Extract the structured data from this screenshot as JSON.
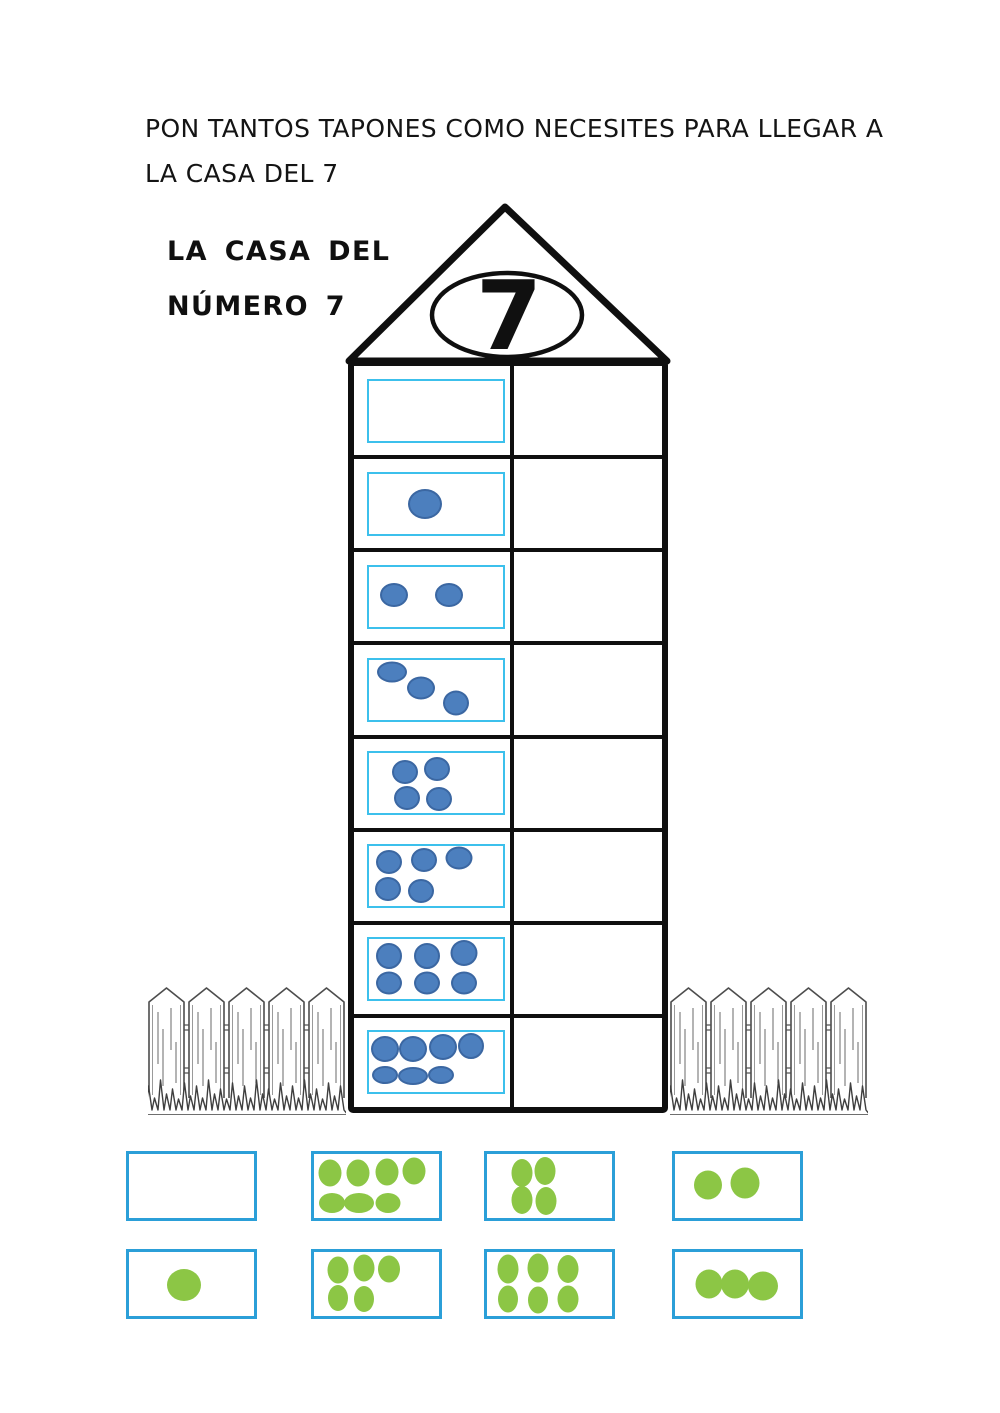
{
  "instruction": {
    "line1": "PON TANTOS TAPONES COMO NECESITES PARA LLEGAR A",
    "line2": "LA CASA DEL 7"
  },
  "house": {
    "label_line1": "LA CASA DEL",
    "label_line2": "NÚMERO 7",
    "roof_number": "7",
    "dot_fill": "#4c7fbe",
    "dot_stroke": "#3b67a2",
    "box_border": "#3cc0ec",
    "rows": [
      {
        "count": 0,
        "dots": []
      },
      {
        "count": 1,
        "dots": [
          [
            42,
            50,
            34,
            30
          ]
        ]
      },
      {
        "count": 2,
        "dots": [
          [
            19,
            47,
            28,
            24
          ],
          [
            60,
            47,
            28,
            24
          ]
        ]
      },
      {
        "count": 3,
        "dots": [
          [
            17,
            20,
            30,
            21
          ],
          [
            39,
            47,
            28,
            23
          ],
          [
            65,
            71,
            26,
            25
          ]
        ]
      },
      {
        "count": 4,
        "dots": [
          [
            27,
            31,
            26,
            24
          ],
          [
            51,
            27,
            26,
            24
          ],
          [
            28,
            75,
            26,
            24
          ],
          [
            52,
            77,
            26,
            24
          ]
        ]
      },
      {
        "count": 5,
        "dots": [
          [
            15,
            27,
            26,
            24
          ],
          [
            41,
            23,
            26,
            24
          ],
          [
            67,
            19,
            27,
            23
          ],
          [
            14,
            71,
            26,
            24
          ],
          [
            39,
            74,
            26,
            24
          ]
        ]
      },
      {
        "count": 6,
        "dots": [
          [
            15,
            27,
            26,
            26
          ],
          [
            43,
            27,
            26,
            26
          ],
          [
            71,
            23,
            27,
            26
          ],
          [
            15,
            73,
            26,
            23
          ],
          [
            43,
            73,
            26,
            23
          ],
          [
            71,
            73,
            26,
            23
          ]
        ]
      },
      {
        "count": 7,
        "dots": [
          [
            12,
            27,
            28,
            26
          ],
          [
            33,
            27,
            28,
            26
          ],
          [
            55,
            25,
            28,
            26
          ],
          [
            76,
            23,
            26,
            26
          ],
          [
            12,
            71,
            26,
            18
          ],
          [
            33,
            73,
            30,
            18
          ],
          [
            54,
            71,
            26,
            18
          ]
        ]
      }
    ]
  },
  "cards": {
    "border": "#2b9fd8",
    "dot_fill": "#8cc645",
    "items": [
      {
        "count": 0,
        "dots": []
      },
      {
        "count": 7,
        "dots": [
          [
            13,
            30,
            23,
            27
          ],
          [
            35,
            30,
            23,
            27
          ],
          [
            58,
            28,
            23,
            27
          ],
          [
            80,
            26,
            23,
            27
          ],
          [
            14,
            76,
            26,
            20
          ],
          [
            36,
            76,
            30,
            20
          ],
          [
            59,
            76,
            25,
            20
          ]
        ]
      },
      {
        "count": 4,
        "dots": [
          [
            28,
            30,
            21,
            28
          ],
          [
            46,
            27,
            21,
            28
          ],
          [
            28,
            72,
            21,
            28
          ],
          [
            47,
            73,
            21,
            28
          ]
        ]
      },
      {
        "count": 2,
        "dots": [
          [
            26,
            48,
            28,
            29
          ],
          [
            56,
            45,
            29,
            31
          ]
        ]
      },
      {
        "count": 1,
        "dots": [
          [
            44,
            52,
            34,
            32
          ]
        ]
      },
      {
        "count": 5,
        "dots": [
          [
            19,
            28,
            21,
            27
          ],
          [
            40,
            25,
            21,
            27
          ],
          [
            60,
            27,
            22,
            27
          ],
          [
            19,
            72,
            20,
            26
          ],
          [
            40,
            74,
            20,
            26
          ]
        ]
      },
      {
        "count": 6,
        "dots": [
          [
            17,
            27,
            21,
            29
          ],
          [
            41,
            25,
            21,
            29
          ],
          [
            65,
            27,
            21,
            28
          ],
          [
            17,
            73,
            20,
            27
          ],
          [
            41,
            75,
            20,
            27
          ],
          [
            65,
            73,
            21,
            27
          ]
        ]
      },
      {
        "count": 3,
        "dots": [
          [
            27,
            50,
            27,
            29
          ],
          [
            48,
            50,
            28,
            29
          ],
          [
            70,
            53,
            30,
            29
          ]
        ]
      }
    ]
  }
}
